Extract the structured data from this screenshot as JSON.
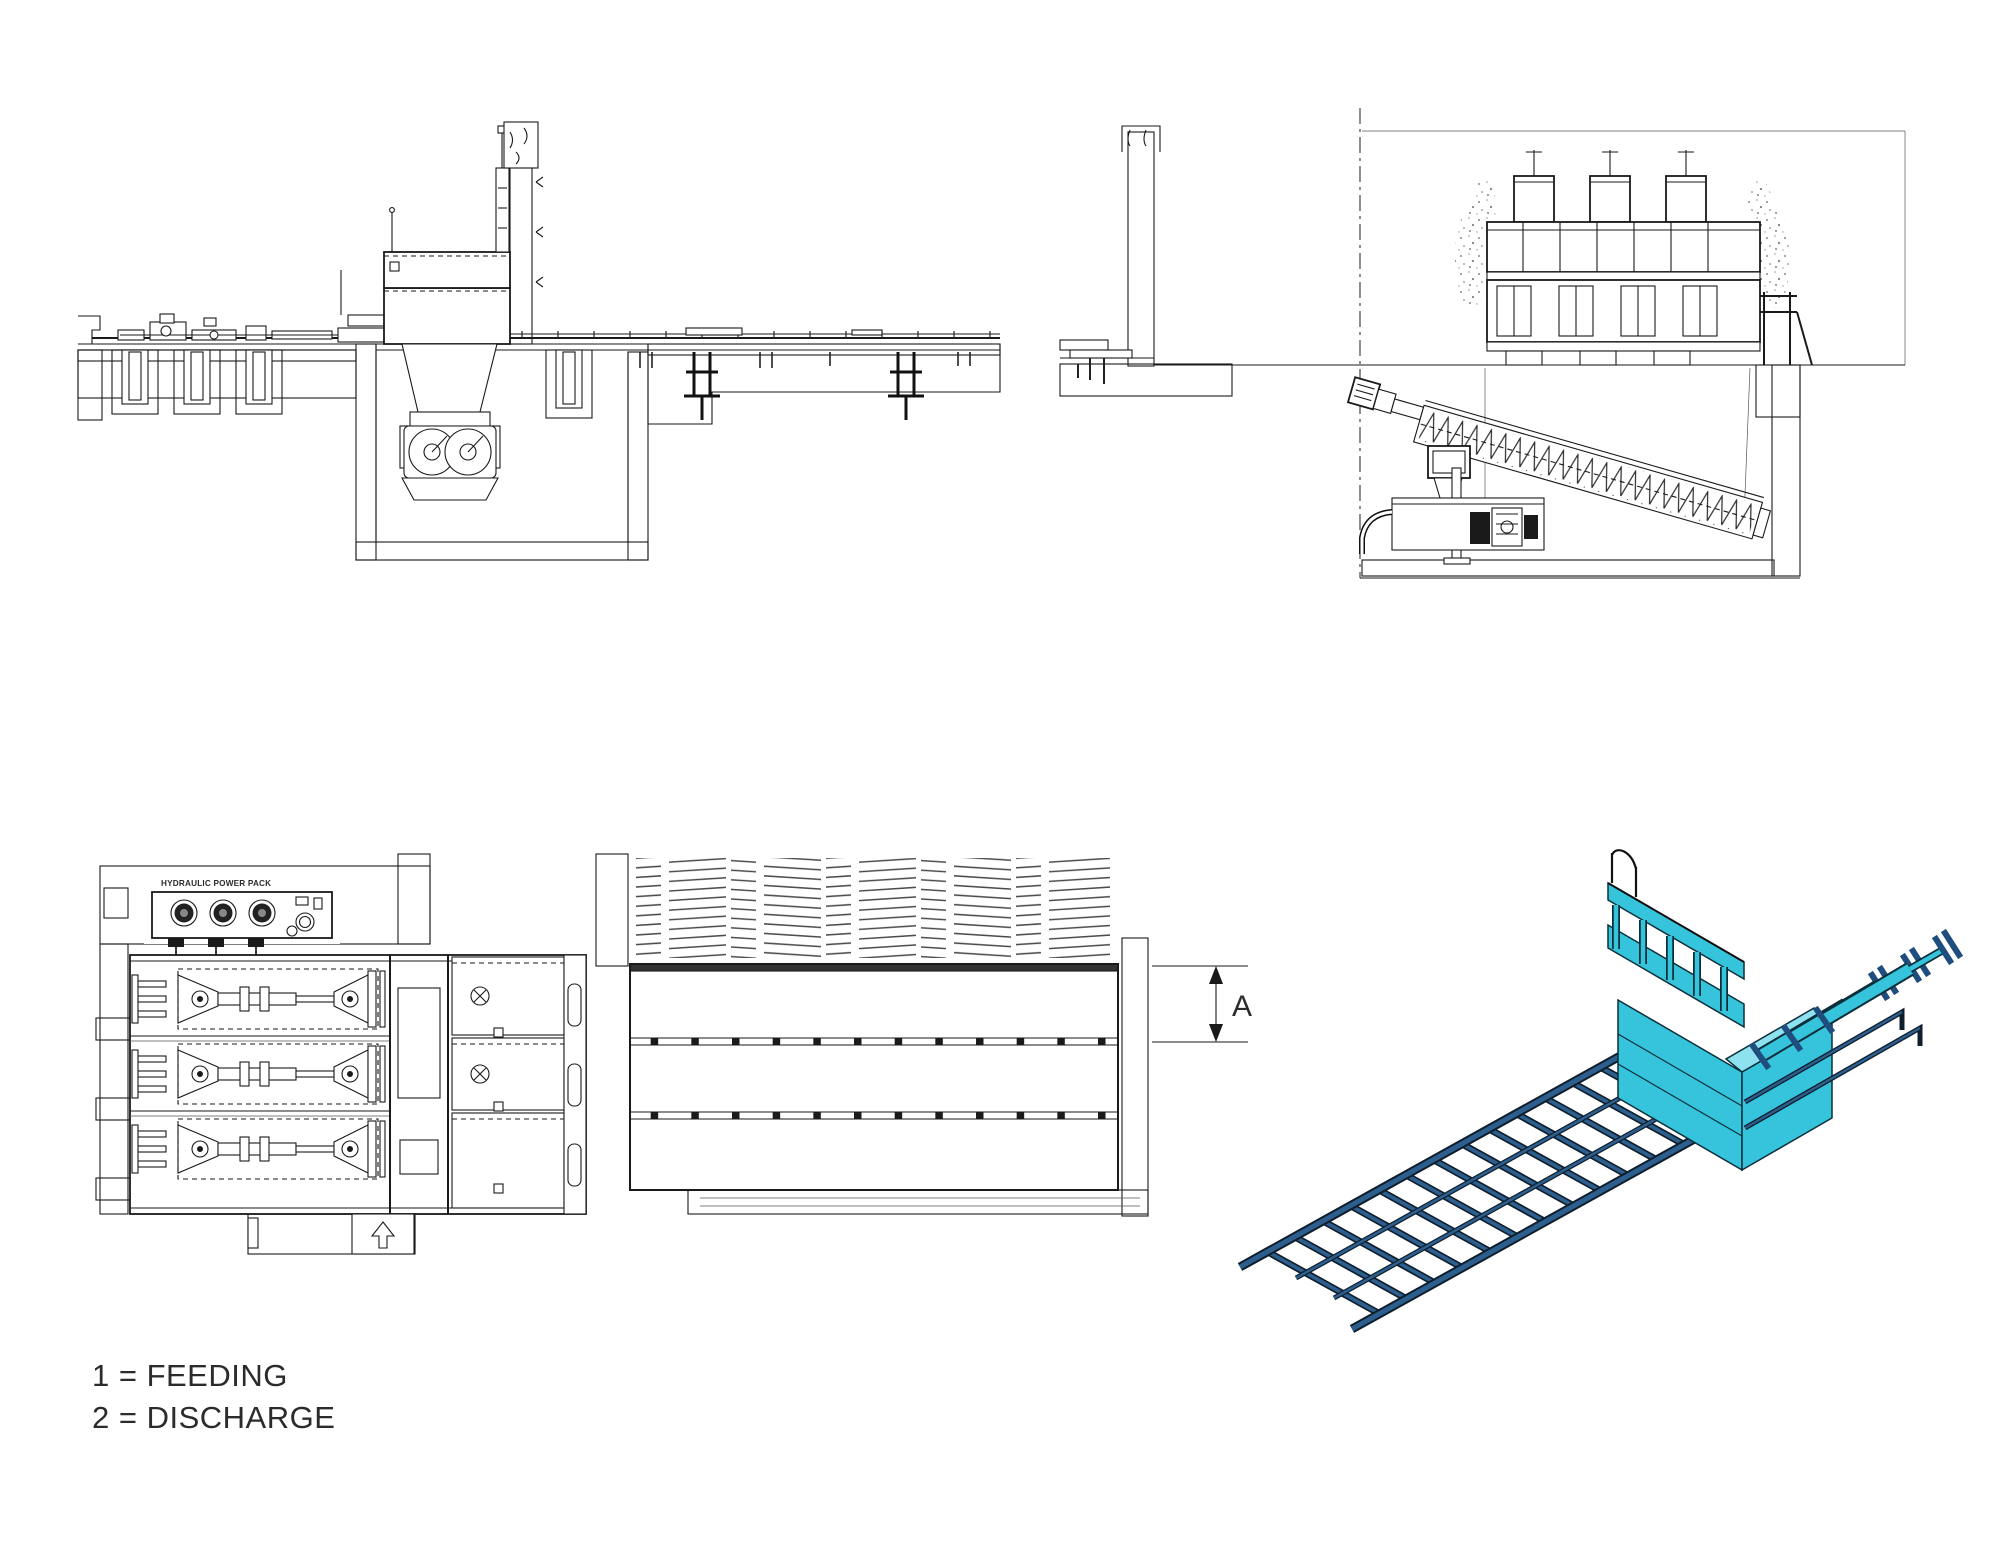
{
  "drawing": {
    "type": "technical-cad-multiview",
    "background": "#ffffff",
    "views": {
      "side_elevation": "side section elevation with discharge pit and twin screw unit",
      "end_elevation": "end elevation with inclined screw conveyor in pit",
      "plan": "plan view with hydraulic feeding cylinders and grid floor",
      "isometric": "isometric view of feeding module with push-floor grid ramp"
    }
  },
  "labels": {
    "hydraulic_power_pack": "HYDRAULIC POWER PACK",
    "dimension_a": "A"
  },
  "legend": {
    "line1": "1 = FEEDING",
    "line2": "2 = DISCHARGE",
    "entries": [
      {
        "key": "1",
        "value": "FEEDING"
      },
      {
        "key": "2",
        "value": "DISCHARGE"
      }
    ]
  },
  "colors": {
    "line": "#1a1a1a",
    "cyan": "#35C4DC",
    "cyan_dark": "#1FA9C4",
    "cyan_light": "#8EE2F0",
    "blue": "#2D5F8E",
    "blue_dark": "#1F4E7E"
  }
}
